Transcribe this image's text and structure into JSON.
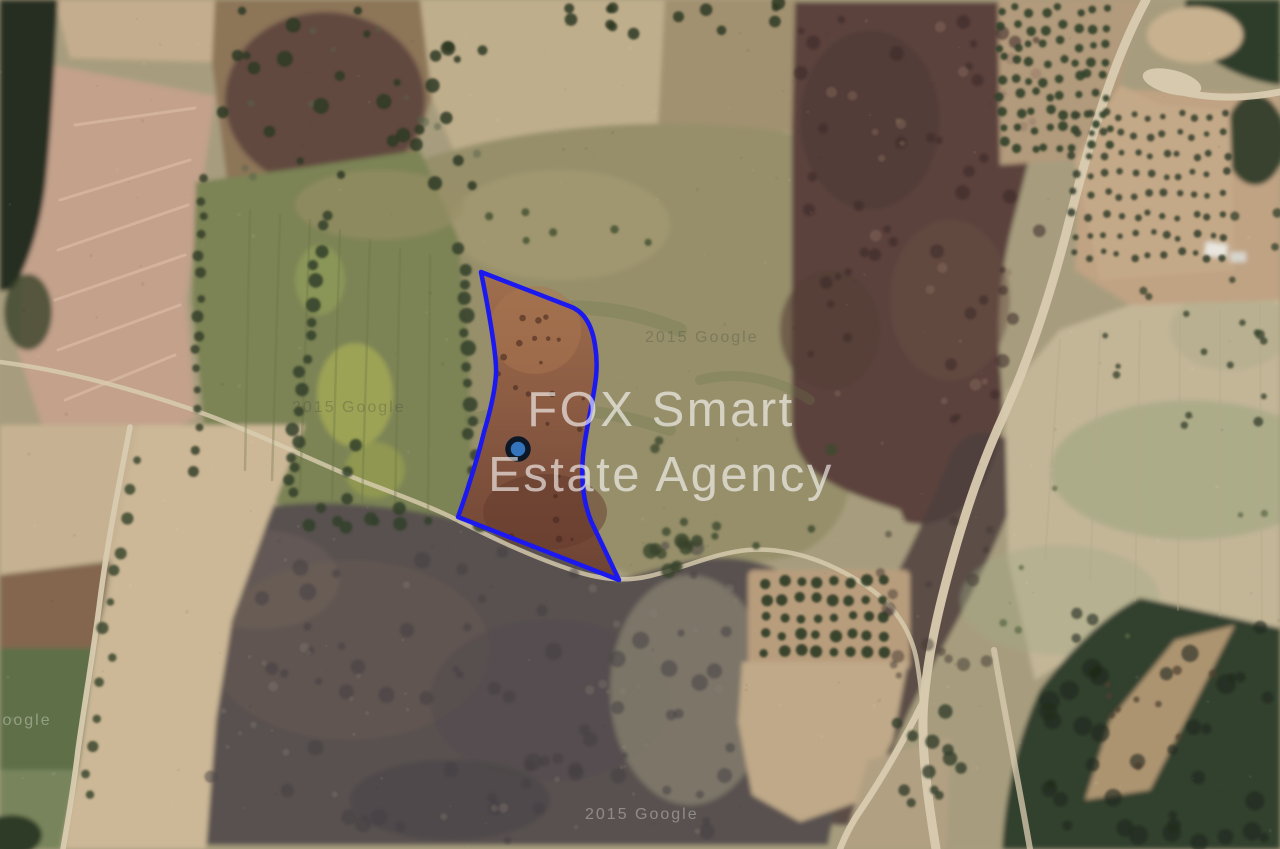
{
  "map": {
    "imagery_type": "satellite",
    "watermark": {
      "line1": "FOX Smart",
      "line2": "Estate Agency"
    },
    "attribution": {
      "text": "2015 Google"
    },
    "parcel": {
      "outline_color": "#1b18f0",
      "soil_top_color": "#a06f4e",
      "soil_bottom_color": "#6d4334"
    },
    "marker": {
      "fill_color": "#3474bd",
      "ring_color": "#0d1826"
    }
  }
}
